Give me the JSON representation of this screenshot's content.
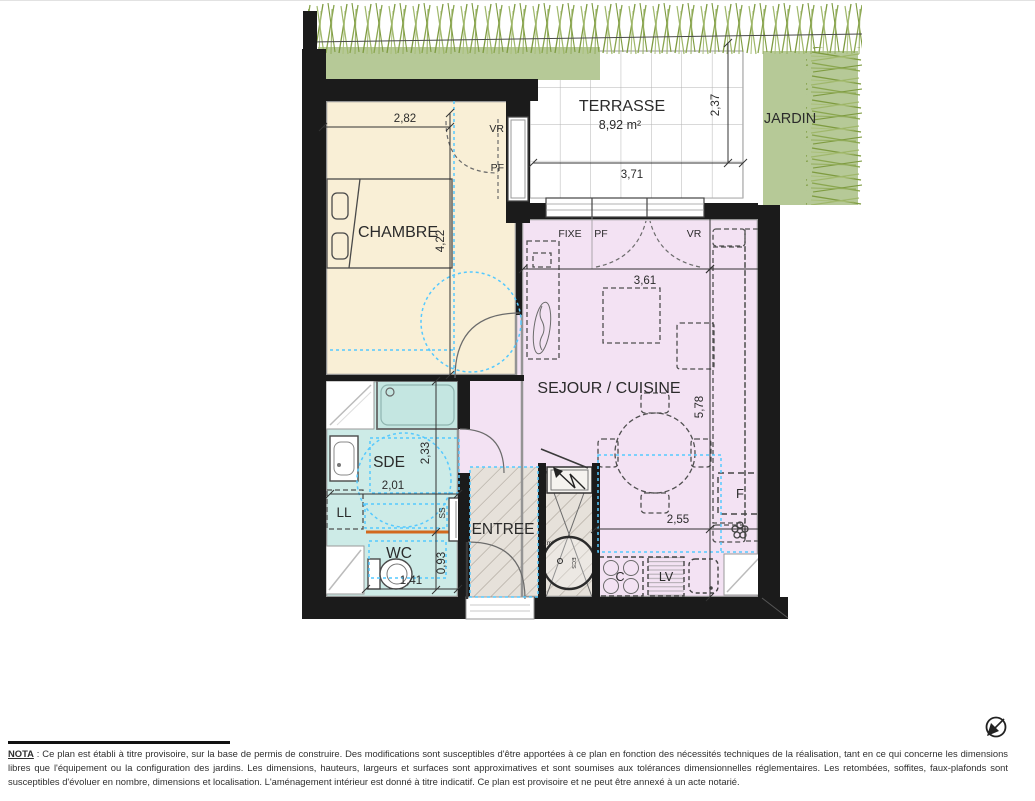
{
  "rooms": {
    "terrasse": {
      "label": "TERRASSE",
      "area": "8,92 m²"
    },
    "jardin": {
      "label": "JARDIN"
    },
    "chambre": {
      "label": "CHAMBRE"
    },
    "sejour_cuisine": {
      "label": "SEJOUR / CUISINE"
    },
    "sde": {
      "label": "SDE"
    },
    "wc": {
      "label": "WC"
    },
    "entree": {
      "label": "ENTREE"
    }
  },
  "fixtures": {
    "lave_linge": "LL",
    "seche_serviettes": "SS",
    "refrigerateur": "F",
    "cuisson": "C",
    "lave_vaisselle": "LV",
    "placard_area": "1m²",
    "chauffe_eau": "ECS"
  },
  "openings": {
    "volet_roulant": "VR",
    "porte_fenetre": "PF",
    "fixe": "FIXE"
  },
  "dims": {
    "chambre_w": "2,82",
    "chambre_h": "4,22",
    "terrasse_w": "3,71",
    "terrasse_d": "2,37",
    "sejour_w": "3,61",
    "sejour_h": "5,78",
    "cuisine_w": "2,55",
    "sde_h": "2,33",
    "sde_w": "2,01",
    "wc_h": "0,93",
    "wc_w": "1,41"
  },
  "nota": {
    "label": "NOTA",
    "text": " : Ce plan est établi à titre provisoire, sur la base de permis de construire. Des modifications sont susceptibles d'être apportées à ce plan en fonction des nécessités techniques de la réalisation, tant en ce qui concerne les dimensions libres que l'équipement ou la configuration des jardins. Les dimensions, hauteurs, largeurs et surfaces sont approximatives et sont soumises aux tolérances dimensionnelles réglementaires. Les retombées, soffites, faux-plafonds sont susceptibles d'évoluer en nombre, dimensions et localisation. L'aménagement intérieur est donné à titre indicatif. Ce plan est provisoire et ne peut être annexé à un acte notarié."
  },
  "colors": {
    "chambre": "#f9efd6",
    "sejour": "#f3e2f3",
    "sanitaire": "#cdebe7",
    "jardin": "#b6c997",
    "entree": "#e6e1da",
    "wall": "#1b1b1b",
    "zone_blue": "#55c9ff",
    "seuil_orange": "#d2691e"
  }
}
